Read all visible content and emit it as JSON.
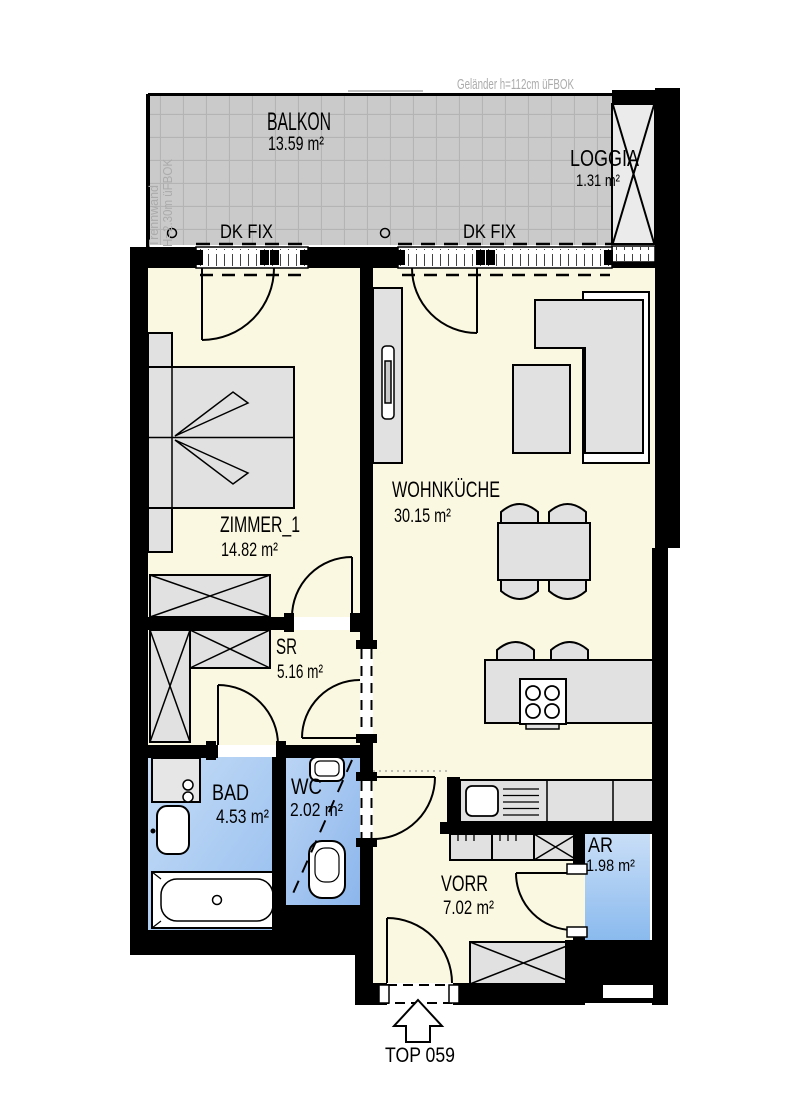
{
  "plan": {
    "annotations": {
      "railing_note": "Geländer h=112cm üFBOK",
      "partition_note": "Trennwand",
      "partition_note_height": "H=2.30m üFBOK",
      "window_labels": [
        "DK FIX",
        "DK FIX"
      ],
      "entrance_label": "TOP 059"
    },
    "rooms": {
      "balkon": {
        "name": "BALKON",
        "area": "13.59 m²"
      },
      "loggia": {
        "name": "LOGGIA",
        "area": "1.31 m²"
      },
      "zimmer1": {
        "name": "ZIMMER_1",
        "area": "14.82 m²"
      },
      "wohnkueche": {
        "name": "WOHNKÜCHE",
        "area": "30.15 m²"
      },
      "sr": {
        "name": "SR",
        "area": "5.16 m²"
      },
      "bad": {
        "name": "BAD",
        "area": "4.53 m²"
      },
      "wc": {
        "name": "WC",
        "area": "2.02 m²"
      },
      "vorr": {
        "name": "VORR",
        "area": "7.02 m²"
      },
      "ar": {
        "name": "AR",
        "area": "1.98 m²"
      }
    },
    "colors": {
      "wall": "#000000",
      "floor_cream": "#FBF8E1",
      "wet_room_blue_light": "#C6DCF6",
      "wet_room_blue_dark": "#8FBAEE",
      "balcony_tile": "#CACACA",
      "furniture_gray": "#E1E1E1",
      "note_gray": "#ABABAB"
    }
  }
}
